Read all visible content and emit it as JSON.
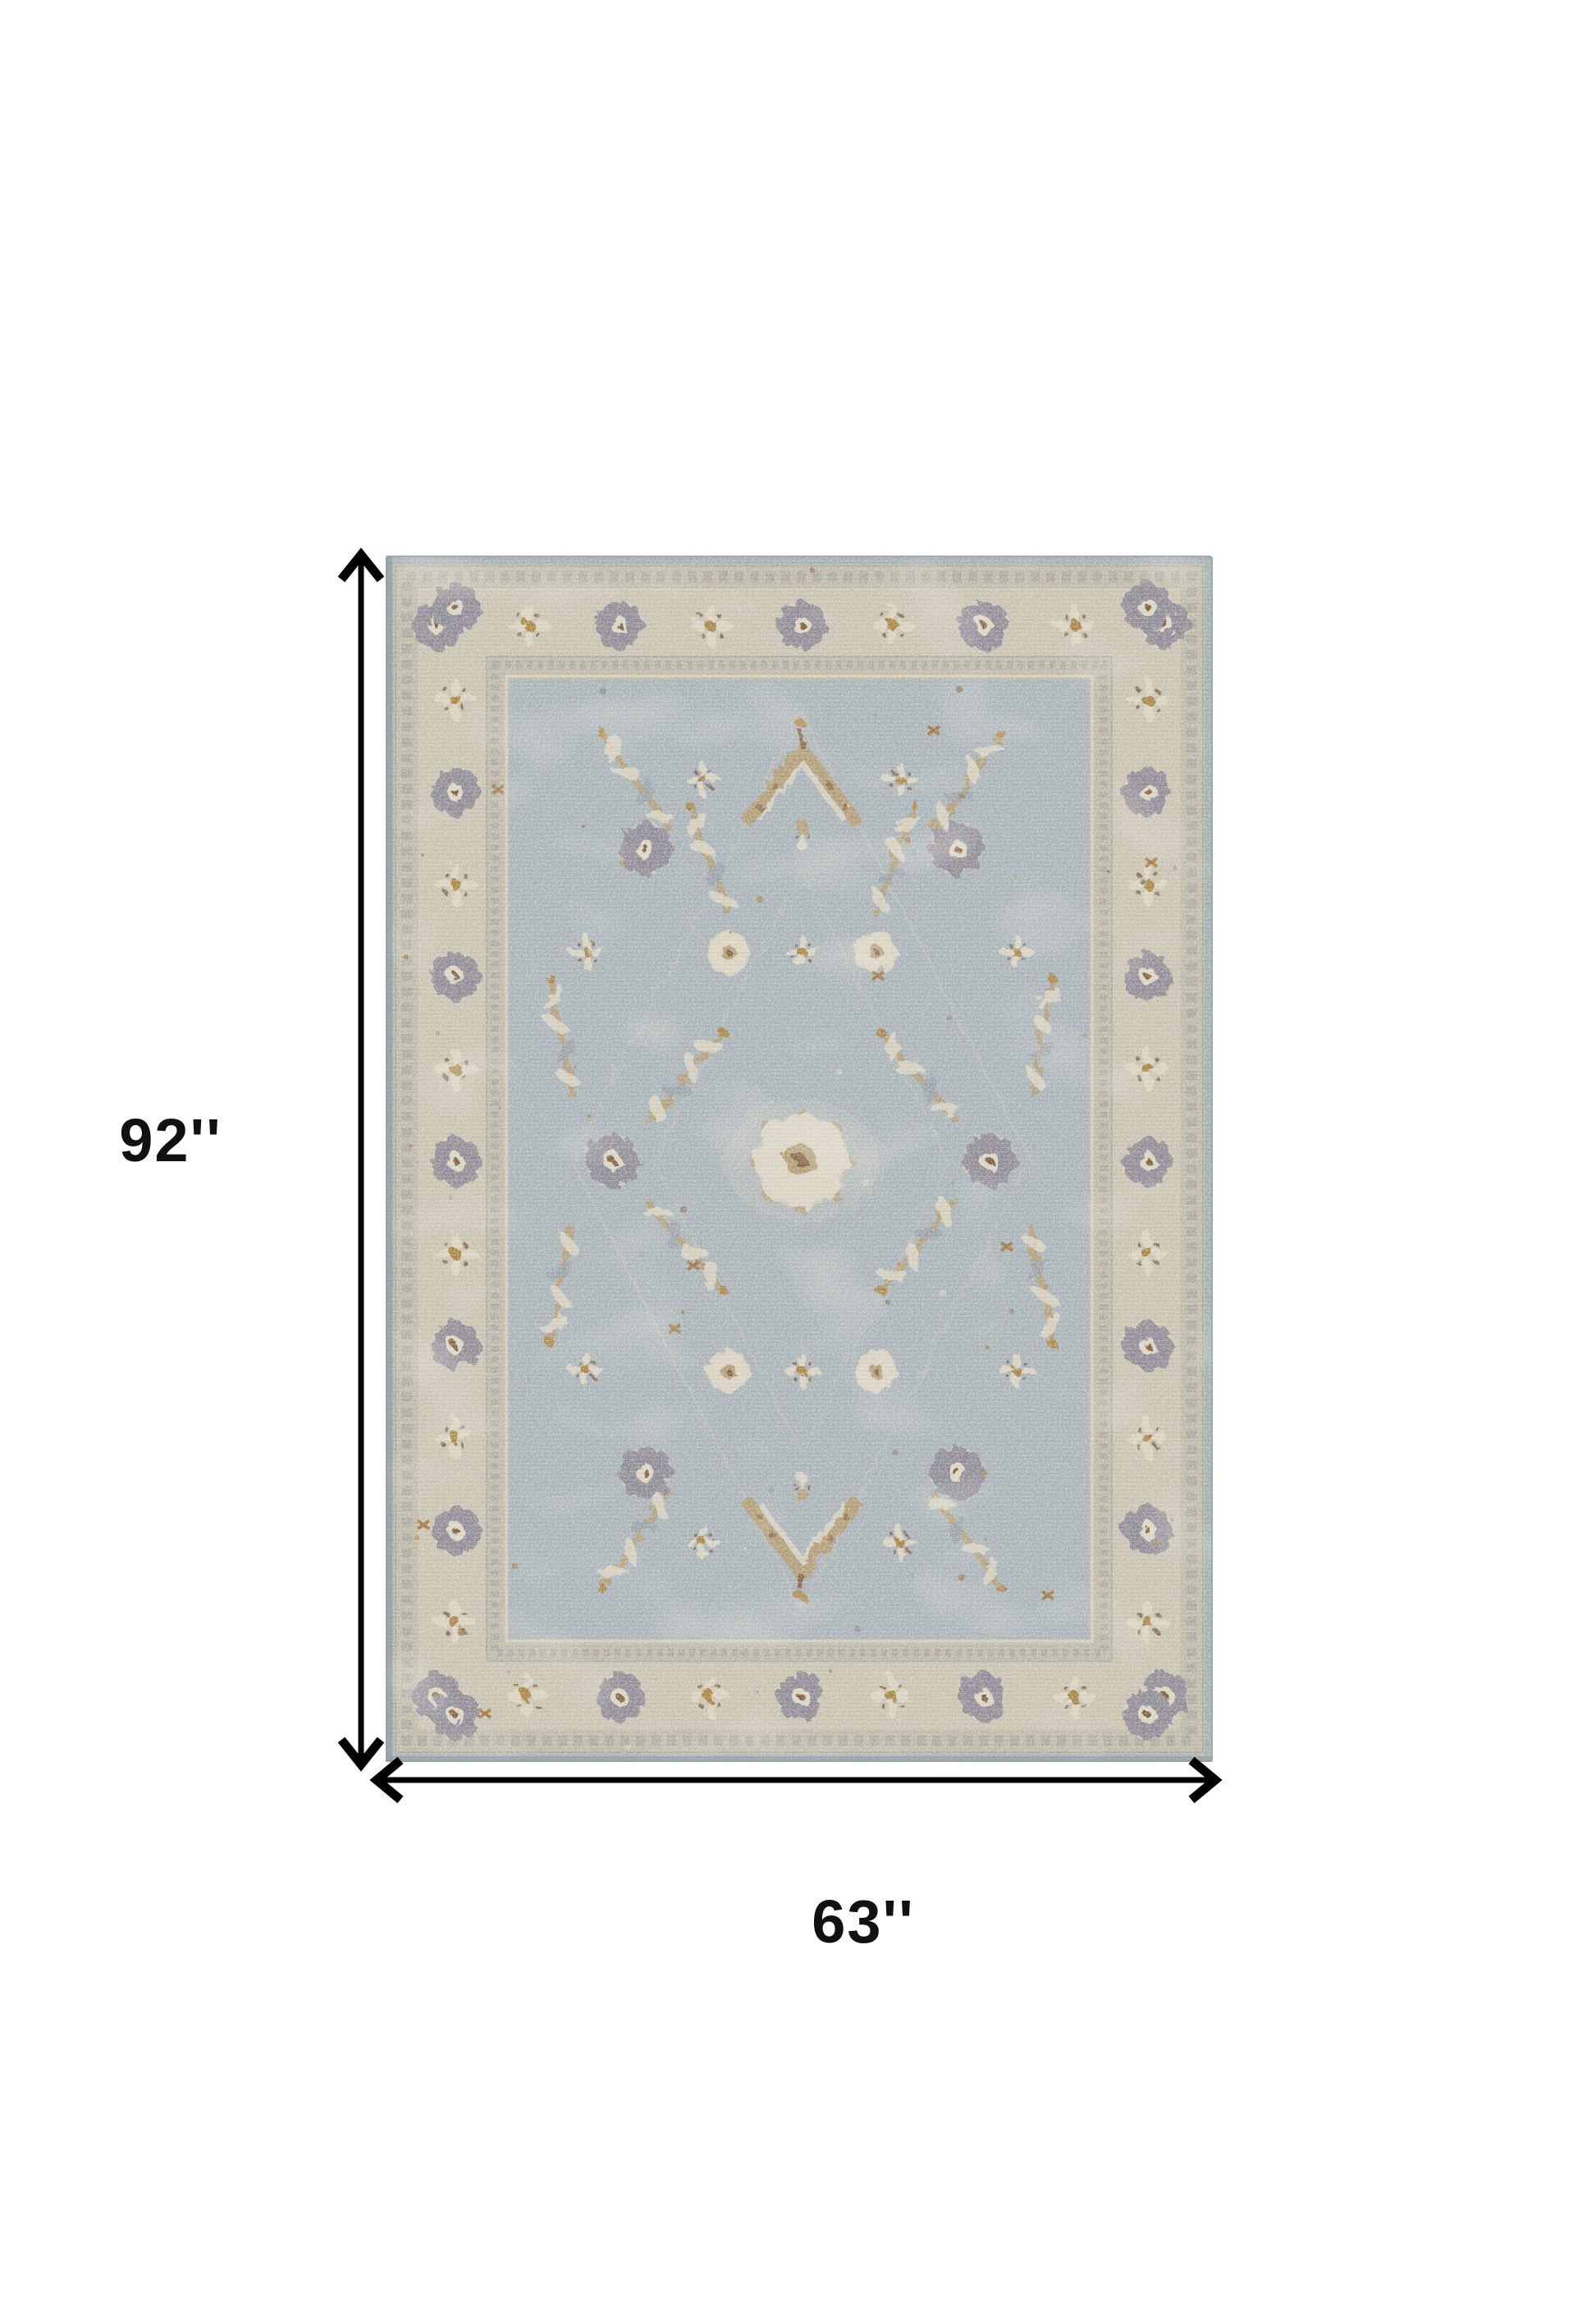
{
  "page": {
    "background": "#ffffff"
  },
  "dimensions": {
    "height_label": "92''",
    "width_label": "63''",
    "arrow_color": "#000000",
    "label_color": "#111111"
  },
  "icons": {
    "height_arrow": "double-headed-vertical-arrow",
    "width_arrow": "double-headed-horizontal-arrow"
  },
  "rug": {
    "colors": {
      "edge": "#a3aeb2",
      "edge_shade": "#8d989d",
      "border_base": "#c9c3b1",
      "guard_band": "#bfb9a8",
      "guard_line": "#8f9894",
      "field": "#a9b3b8",
      "cream": "#dbd5c3",
      "vine": "#cfc9b7",
      "tan": "#b39b72",
      "gold": "#a8833f",
      "rust": "#9c6a30",
      "brown": "#7c5a3b",
      "blue_gray": "#96a1a9",
      "purple_gray": "#8b8793"
    }
  }
}
